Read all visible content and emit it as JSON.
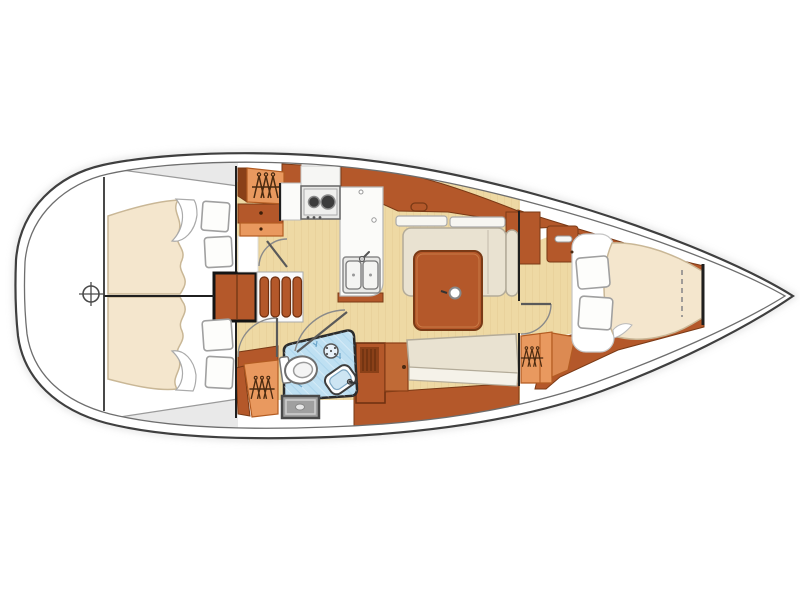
{
  "diagram": {
    "type": "floorplan",
    "subject": "Sailing yacht interior layout plan, top-down view, bow pointing right",
    "orientation": "bow-right",
    "rooms": [
      {
        "name": "stern-platform",
        "features": [
          "deck-hatch-crosshair"
        ]
      },
      {
        "name": "port-aft-cabin",
        "features": [
          "double-berth",
          "two-pillows",
          "hanging-locker",
          "drawers",
          "door"
        ]
      },
      {
        "name": "starboard-aft-cabin",
        "features": [
          "double-berth",
          "two-pillows",
          "hanging-locker",
          "door"
        ]
      },
      {
        "name": "companionway",
        "features": [
          "four-step-stairs",
          "engine-compartment"
        ]
      },
      {
        "name": "galley",
        "features": [
          "two-burner-stove",
          "double-sink",
          "counter",
          "overhead-lockers"
        ]
      },
      {
        "name": "salon",
        "features": [
          "u-settee",
          "starboard-bench",
          "dining-table",
          "mast-post",
          "shelves"
        ]
      },
      {
        "name": "head",
        "features": [
          "toilet",
          "wash-basin",
          "shower-head",
          "shower-pan",
          "tiled-floor",
          "door"
        ]
      },
      {
        "name": "forward-cabin",
        "features": [
          "v-berth",
          "two-pillows",
          "hanging-locker",
          "shelf",
          "door",
          "dashed-berth-extension"
        ]
      },
      {
        "name": "anchor-locker",
        "features": [
          "bow-bulkhead"
        ]
      }
    ]
  },
  "colors": {
    "wood": "#b4582a",
    "wood_light": "#c06a36",
    "wood_dark": "#8a4018",
    "floor": "#eed9a4",
    "cushion": "#e9e2d1",
    "cushion_light": "#f5f2e9",
    "bed": "#f4e6cd",
    "pillow": "#fdfdfb",
    "locker_orange": "#e9995f",
    "locker_orange_dark": "#dc8a52",
    "tile_blue": "#bfe0f2",
    "shower_gray": "#a0a0a0",
    "deck_gray": "#e9e9e9",
    "steel": "#e8e8e6",
    "hull_line": "#3f3f3f"
  }
}
